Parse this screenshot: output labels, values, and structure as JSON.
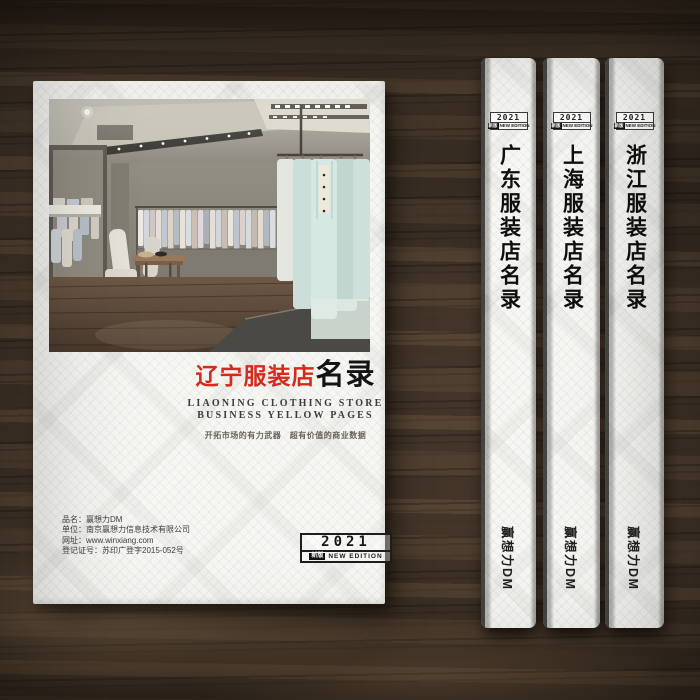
{
  "cover": {
    "title_region": "辽宁服装店",
    "title_suffix": "名录",
    "subtitle_line1": "LIAONING CLOTHING STORE",
    "subtitle_line2": "BUSINESS YELLOW PAGES",
    "slogan": "开拓市场的有力武器　超有价值的商业数据",
    "info_lines": [
      "品名：赢想力DM",
      "单位：南京赢想力信息技术有限公司",
      "网址：www.winxiang.com",
      "登记证号：苏印广登字2015-052号"
    ],
    "edition": {
      "year": "2021",
      "badge": "新版",
      "label": "NEW EDITION"
    },
    "photo_subject": "clothing-store-interior"
  },
  "spines": [
    {
      "title": "广东服装店名录",
      "brand": "赢想力DM",
      "edition": {
        "year": "2021",
        "badge": "新版",
        "label": "NEW EDITION"
      }
    },
    {
      "title": "上海服装店名录",
      "brand": "赢想力DM",
      "edition": {
        "year": "2021",
        "badge": "新版",
        "label": "NEW EDITION"
      }
    },
    {
      "title": "浙江服装店名录",
      "brand": "赢想力DM",
      "edition": {
        "year": "2021",
        "badge": "新版",
        "label": "NEW EDITION"
      }
    }
  ],
  "colors": {
    "accent_red": "#d52a1c",
    "ink": "#141414",
    "paper": "#f6f6f3",
    "wood": "#4c3e31",
    "suit_mint": "#d6e8e2"
  }
}
